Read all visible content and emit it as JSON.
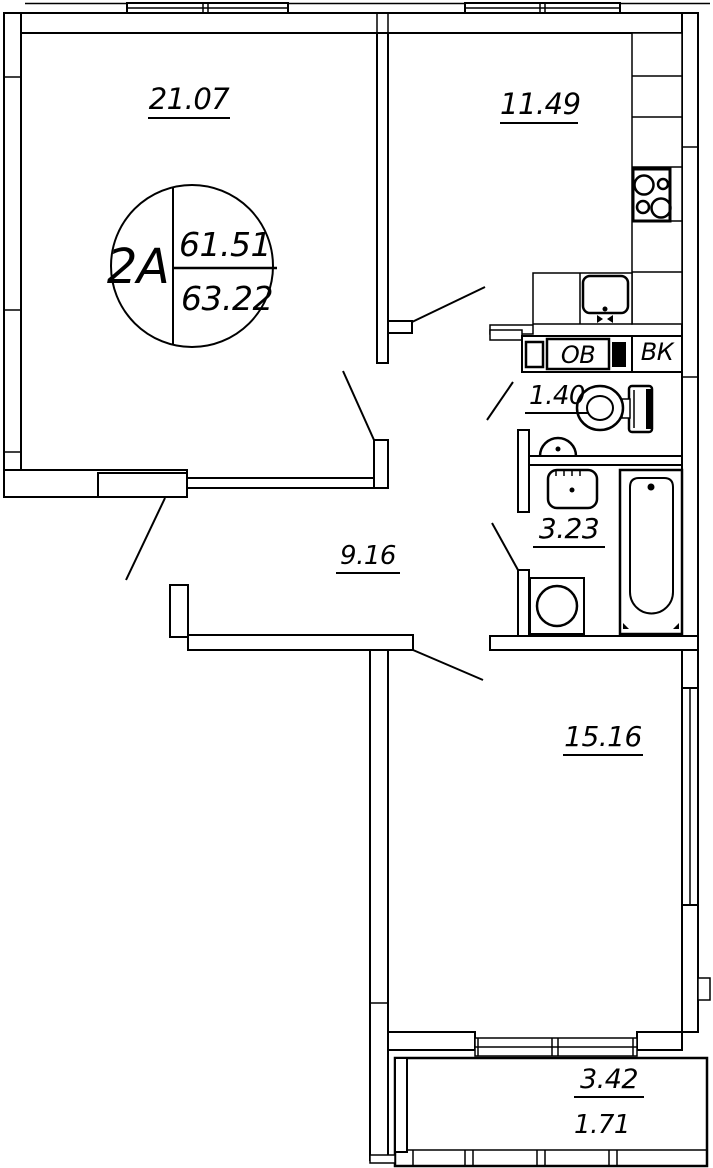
{
  "stamp": {
    "unit": "2A",
    "area_living": "61.51",
    "area_total": "63.22"
  },
  "rooms": {
    "living_room": "21.07",
    "kitchen": "11.49",
    "toilet": "1.40",
    "bathroom": "3.23",
    "hallway": "9.16",
    "bedroom": "15.16"
  },
  "balcony": {
    "area_full": "3.42",
    "area_reduced": "1.71"
  },
  "shafts": {
    "heating_shaft": "ОВ",
    "plumbing_shaft": "ВК"
  },
  "colors": {
    "line": "#000000",
    "background": "#ffffff"
  }
}
